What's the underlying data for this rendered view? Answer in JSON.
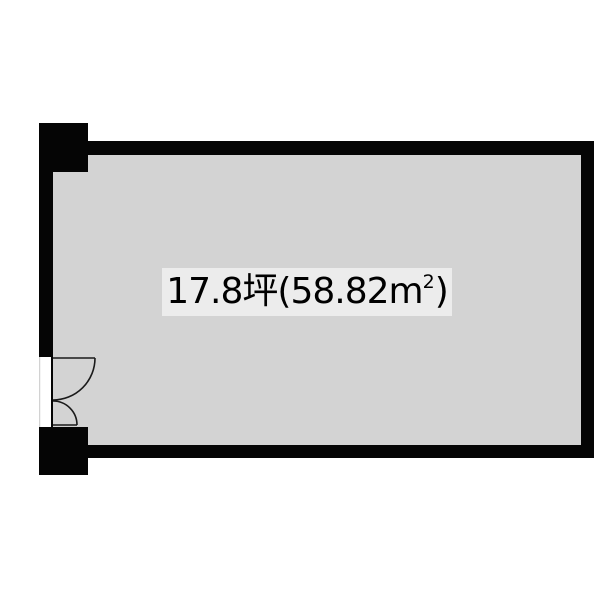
{
  "page": {
    "background_color": "#ffffff"
  },
  "floorplan": {
    "area_label": {
      "full_text": "17.8坪(58.82㎡)",
      "value_tsubo": "17.8",
      "unit_tsubo": "坪",
      "paren_open": "(",
      "value_sqm": "58.82",
      "unit_sqm_base": "m",
      "unit_sqm_sup": "2",
      "paren_close": ")"
    },
    "colors": {
      "wall": "#050505",
      "floor": "#d3d3d3",
      "label_background": "#ececec",
      "label_text": "#000000",
      "door_line": "#1a1a1a",
      "opening_edge": "#c6c6c6",
      "background": "#ffffff"
    }
  }
}
